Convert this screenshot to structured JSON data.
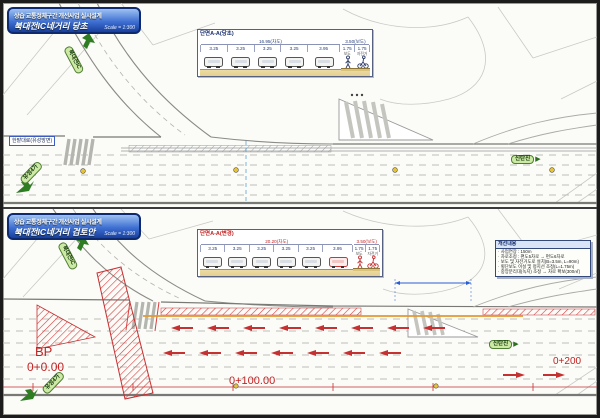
{
  "panels": [
    {
      "title_line1": "상습 교통정체구간 개선사업 실시설계",
      "title_line2": "북대전IC네거리 당초",
      "scale": "Scale = 1:300",
      "section": {
        "title": "단면A-A(당초)",
        "dim_road": "16.95(차도)",
        "dim_walk": "3.50(보도)",
        "lanes": [
          "3.25",
          "3.25",
          "3.25",
          "3.25",
          "3.95"
        ],
        "walk_widths": [
          "1.75",
          "1.75"
        ],
        "walk_labels": [
          "보도",
          "자전거"
        ]
      },
      "signs": {
        "ramp": "북대전IC",
        "left": "유성4가",
        "right": "신탄진",
        "road": "한밭대로(유성방면)"
      }
    },
    {
      "title_line1": "상습 교통정체구간 개선사업 실시설계",
      "title_line2": "북대전IC네거리 검토안",
      "scale": "Scale = 1:300",
      "section": {
        "title": "단면A-A(변경)",
        "dim_road": "20.20(차도)",
        "dim_walk": "3.50(보도)",
        "lanes": [
          "3.25",
          "3.25",
          "3.25",
          "3.25",
          "3.25",
          "3.95"
        ],
        "walk_widths": [
          "1.75",
          "1.75"
        ],
        "walk_labels": [
          "보도",
          "자전거"
        ]
      },
      "signs": {
        "ramp": "북대전IC",
        "left": "유성4가",
        "right": "신탄진"
      },
      "stations": {
        "bp_label": "BP",
        "bp_value": "0+0.00",
        "mid": "0+100.00",
        "end": "0+200"
      },
      "notes": {
        "title": "개선내용",
        "items": [
          "사업연장 : 150m",
          "차로조정 : 편도5차로 → 편도6차로",
          "보도 및 자전거도로 설치(B=3.5m, L=90m)",
          "횡단보도 이설 및 정지선 조정(L=1.75m)",
          "중앙분리대(녹지) 조정 → 차로 확보(300㎡)"
        ]
      }
    }
  ]
}
